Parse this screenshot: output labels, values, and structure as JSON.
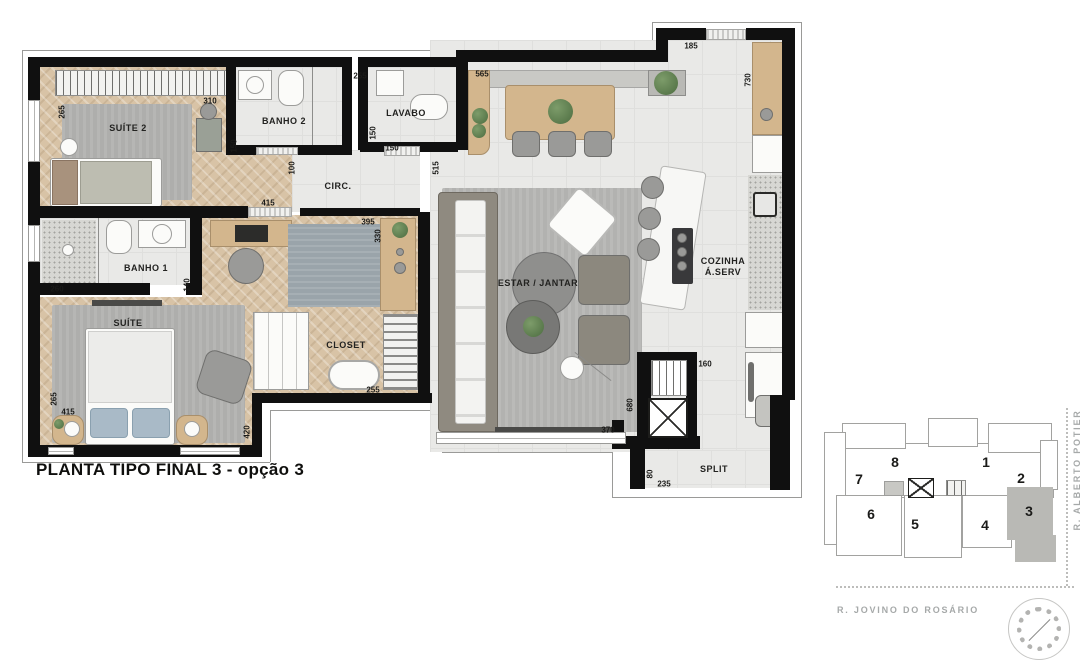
{
  "title": "PLANTA TIPO FINAL  3 - opção 3",
  "colors": {
    "wall": "#101010",
    "tile_floor": "#e9e9e7",
    "wood_floor": "#d8c3a6",
    "rug": "#aeaeac",
    "keyplan_highlight": "#b9b9b5"
  },
  "plan": {
    "rooms": {
      "suite2": "SUÍTE 2",
      "banho2": "BANHO 2",
      "lavabo": "LAVABO",
      "circ": "CIRC.",
      "banho1": "BANHO 1",
      "suite": "SUÍTE",
      "closet": "CLOSET",
      "estar": "ESTAR / JANTAR",
      "cozinha1": "COZINHA",
      "cozinha2": "Á.SERV",
      "split": "SPLIT"
    },
    "dims": {
      "suite2_w": "265",
      "suite2_l": "310",
      "banho2_w": "255",
      "banho2_h": "150",
      "lavabo_h": "150",
      "lavabo_w": "150",
      "dining_buffet": "565",
      "dining_h": "515",
      "kitchen_door": "185",
      "kitchen_len": "730",
      "circ_w": "100",
      "circ_len": "415",
      "office_w": "395",
      "office_d": "330",
      "banho1_w": "260",
      "banho1_h": "140",
      "closet_w": "255",
      "suite_w": "265",
      "suite_l": "415",
      "suite_d": "420",
      "estar_w": "370",
      "estar_l": "680",
      "hall_w": "160",
      "split_h": "80",
      "split_w": "235"
    }
  },
  "keyplan": {
    "units": {
      "u1": "1",
      "u2": "2",
      "u3": "3",
      "u4": "4",
      "u5": "5",
      "u6": "6",
      "u7": "7",
      "u8": "8"
    },
    "highlighted_unit": "3",
    "streets": {
      "right": "R. ALBERTO POTIER",
      "bottom": "R. JOVINO DO ROSÁRIO"
    }
  }
}
